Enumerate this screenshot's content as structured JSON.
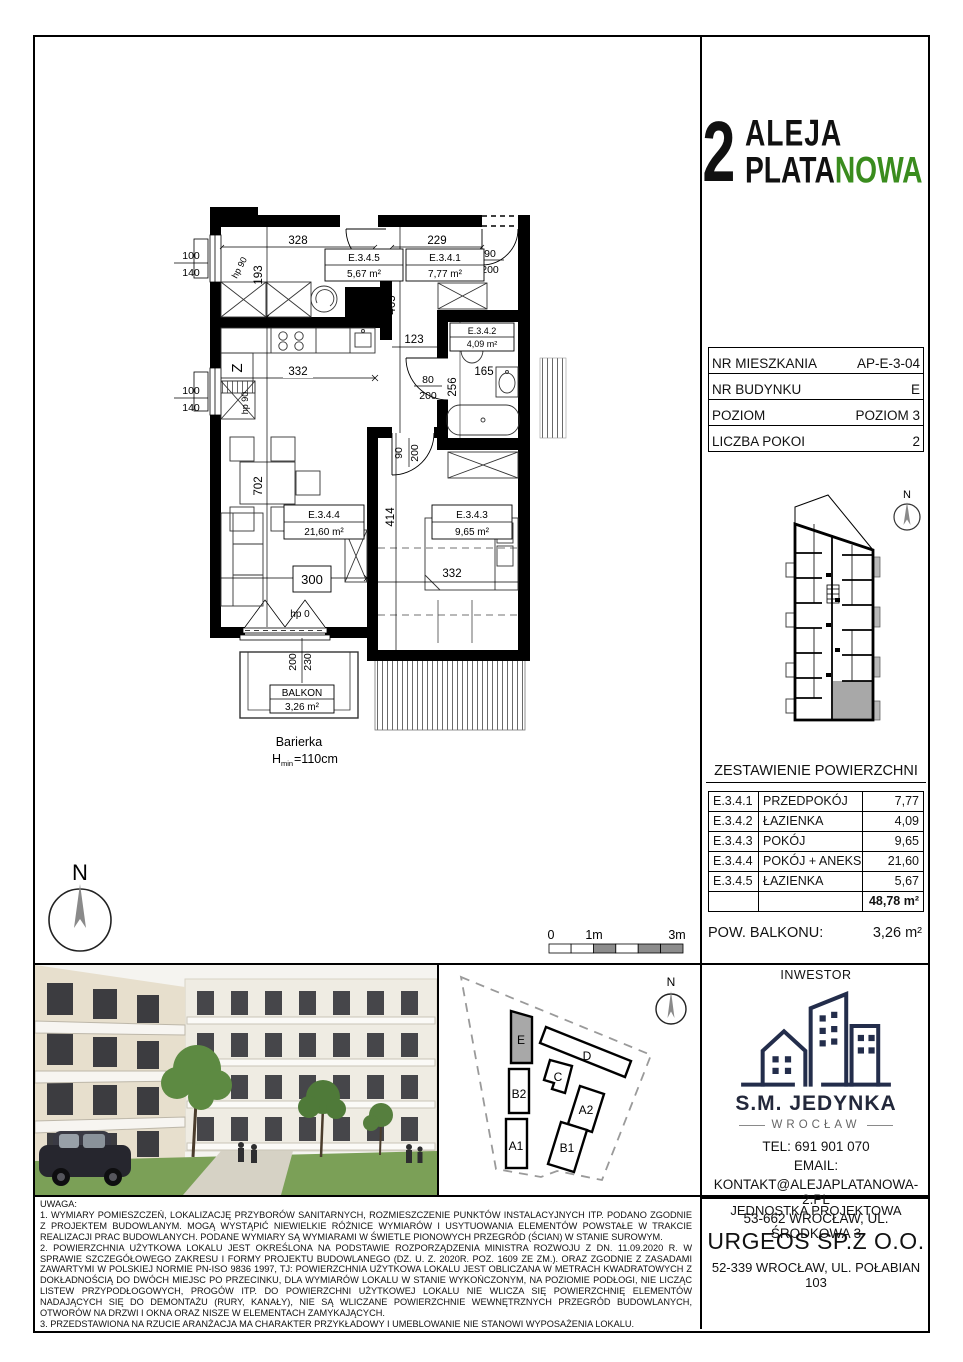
{
  "logo": {
    "number": "2",
    "word1": "ALEJA",
    "word2a": "PLATA",
    "word2b": "NOWA"
  },
  "colors": {
    "green": "#3a8c1e",
    "navy": "#232d4b",
    "highlight_gray": "#a8a8a8"
  },
  "compass_n": "N",
  "unit_info": {
    "rows": [
      {
        "label": "NR MIESZKANIA",
        "value": "AP-E-3-04"
      },
      {
        "label": "NR BUDYNKU",
        "value": "E"
      },
      {
        "label": "POZIOM",
        "value": "POZIOM 3"
      },
      {
        "label": "LICZBA POKOI",
        "value": "2"
      }
    ]
  },
  "areas": {
    "title": "ZESTAWIENIE POWIERZCHNI",
    "rows": [
      {
        "code": "E.3.4.1",
        "name": "PRZEDPOKÓJ",
        "area": "7,77"
      },
      {
        "code": "E.3.4.2",
        "name": "ŁAZIENKA",
        "area": "4,09"
      },
      {
        "code": "E.3.4.3",
        "name": "POKÓJ",
        "area": "9,65"
      },
      {
        "code": "E.3.4.4",
        "name": "POKÓJ + ANEKS",
        "area": "21,60"
      },
      {
        "code": "E.3.4.5",
        "name": "ŁAZIENKA",
        "area": "5,67"
      }
    ],
    "total": "48,78 m²",
    "balcony_label": "POW. BALKONU:",
    "balcony_value": "3,26 m²"
  },
  "plan": {
    "rooms": {
      "r5": {
        "code": "E.3.4.5",
        "area": "5,67 m²"
      },
      "r1": {
        "code": "E.3.4.1",
        "area": "7,77 m²"
      },
      "r2": {
        "code": "E.3.4.2",
        "area": "4,09 m²"
      },
      "r4": {
        "code": "E.3.4.4",
        "area": "21,60 m²"
      },
      "r3": {
        "code": "E.3.4.3",
        "area": "9,65 m²"
      }
    },
    "balcony": {
      "name": "BALKON",
      "area": "3,26 m²",
      "railing": "Barierka",
      "railing_h": "H",
      "railing_sub": "min",
      "railing_eq": "=110cm"
    },
    "dims": {
      "d328": "328",
      "d229": "229",
      "d193": "193",
      "d465": "465",
      "d123": "123",
      "d332": "332",
      "d256": "256",
      "d165": "165",
      "d702": "702",
      "d300": "300",
      "d414": "414",
      "w100": "100",
      "w140": "140",
      "d80": "80",
      "d90": "90",
      "d200": "200",
      "d230": "230",
      "hp90": "hp 90",
      "hp0": "hp 0",
      "z": "Z"
    }
  },
  "scalebar": {
    "zero": "0",
    "one": "1m",
    "three": "3m"
  },
  "siteplan": {
    "buildings": [
      "E",
      "D",
      "C",
      "B2",
      "A2",
      "A1",
      "B1"
    ]
  },
  "investor": {
    "title": "INWESTOR",
    "name": "S.M. JEDYNKA",
    "city": "WROCŁAW",
    "tel": "TEL: 691 901 070",
    "email_label": "EMAIL:",
    "email": "KONTAKT@ALEJAPLATANOWA-2.PL",
    "address": "53-662 WROCŁAW, UL. ŚRODKOWA 3"
  },
  "designer": {
    "title": "JEDNOSTKA PROJEKTOWA",
    "name": "URGEOS SP.Z O.O.",
    "address": "52-339 WROCŁAW, UL. POŁABIAN 103"
  },
  "notes": {
    "heading": "UWAGA:",
    "items": [
      "1. WYMIARY POMIESZCZEŃ, LOKALIZACJĘ PRZYBORÓW SANITARNYCH, ROZMIESZCZENIE PUNKTÓW INSTALACYJNYCH ITP. PODANO ZGODNIE Z PROJEKTEM BUDOWLANYM. MOGĄ WYSTĄPIĆ NIEWIELKIE RÓŻNICE WYMIARÓW I USYTUOWANIA ELEMENTÓW POWSTAŁE W TRAKCIE REALIZACJI PRAC BUDOWLANYCH. PODANE WYMIARY SĄ WYMIARAMI W ŚWIETLE PIONOWYCH PRZEGRÓD (ŚCIAN) W STANIE SUROWYM.",
      "2. POWIERZCHNIA UŻYTKOWA LOKALU JEST OKREŚLONA NA PODSTAWIE ROZPORZĄDZENIA MINISTRA ROZWOJU Z DN. 11.09.2020 R. W SPRAWIE SZCZEGÓŁOWEGO ZAKRESU I FORMY PROJEKTU BUDOWLANEGO (DZ. U. Z. 2020R. POZ. 1609 ZE ZM.). ORAZ ZGODNIE Z ZASADAMI ZAWARTYMI W POLSKIEJ NORMIE PN-ISO 9836 1997, TJ: POWIERZCHNIA UŻYTKOWA LOKALU JEST OBLICZANA W METRACH KWADRATOWYCH Z DOKŁADNOŚCIĄ DO DWÓCH MIEJSC PO PRZECINKU, DLA WYMIARÓW LOKALU W STANIE WYKOŃCZONYM, NA POZIOMIE PODŁOGI, NIE LICZĄC LISTEW PRZYPODŁOGOWYCH, PROGÓW ITP. DO POWIERZCHNI UŻYTKOWEJ LOKALU NIE WLICZA SIĘ POWIERZCHNIĘ ELEMENTÓW NADAJĄCYCH SIĘ DO DEMONTAŻU (RURY, KANAŁY), NIE SĄ WLICZANE POWIERZCHNIE WEWNĘTRZNYCH PRZEGRÓD BUDOWLANYCH, OTWORÓW NA DRZWI I OKNA ORAZ NISZE W ELEMENTACH ZAMYKAJĄCYCH.",
      "3. PRZEDSTAWIONA NA RZUCIE ARANŻACJA MA CHARAKTER PRZYKŁADOWY I UMEBLOWANIE NIE STANOWI WYPOSAŻENIA LOKALU."
    ]
  }
}
